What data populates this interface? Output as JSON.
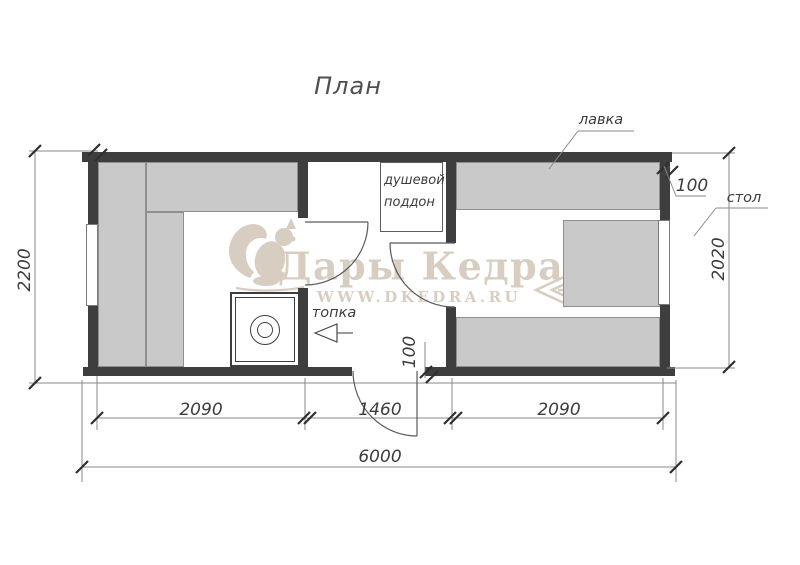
{
  "title": "План",
  "labels": {
    "bench": "лавка",
    "table": "стол",
    "firebox": "топка",
    "shower_line1": "душевой",
    "shower_line2": "поддон"
  },
  "dimensions": {
    "overall_width": "6000",
    "left_room_width": "2090",
    "middle_room_width": "1460",
    "right_room_width": "2090",
    "left_height": "2200",
    "right_height": "2020",
    "wall_thickness": "100",
    "door_offset": "100"
  },
  "watermark": {
    "brand": "Дары Кедра",
    "site": "WWW.DKEDRA.RU"
  },
  "colors": {
    "wall": "#3e3e3e",
    "bench_fill": "#c9c9c9",
    "bench_border": "#8f8f8f",
    "line": "#8a8a8a",
    "tick": "#2f2f2f",
    "door_line": "#5a5a5a",
    "text": "#3c3c3c",
    "watermark": "#d8cdc1",
    "background": "#ffffff"
  }
}
